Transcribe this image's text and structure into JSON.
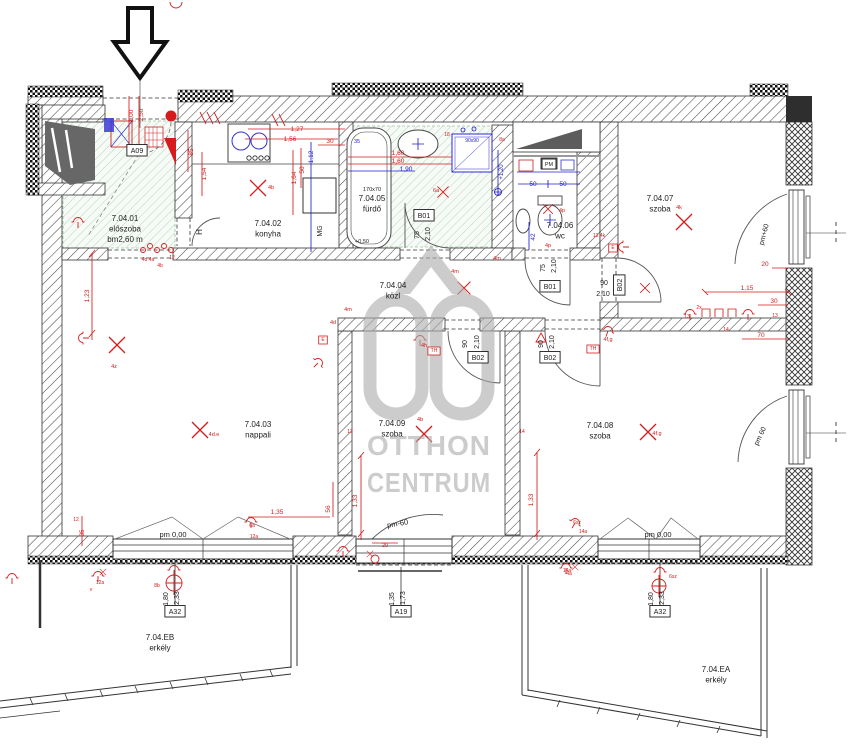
{
  "watermark": {
    "line1": "OTTHON",
    "line2": "CENTRUM",
    "logo": "oc-house-logo",
    "color": "#ababab"
  },
  "rooms": [
    {
      "id": "7.04.01",
      "name": "előszoba",
      "extra": "bm2,60 m",
      "x": 125,
      "y": 221
    },
    {
      "id": "7.04.02",
      "name": "konyha",
      "x": 268,
      "y": 226
    },
    {
      "id": "7.04.05",
      "name": "fürdő",
      "size_note": "170x70",
      "x": 372,
      "y": 201
    },
    {
      "id": "7.04.04",
      "name": "közl",
      "x": 393,
      "y": 288
    },
    {
      "id": "7.04.06",
      "name": "wc",
      "x": 560,
      "y": 228
    },
    {
      "id": "7.04.07",
      "name": "szoba",
      "x": 660,
      "y": 201
    },
    {
      "id": "7.04.03",
      "name": "nappali",
      "x": 258,
      "y": 427
    },
    {
      "id": "7.04.09",
      "name": "szoba",
      "x": 392,
      "y": 426
    },
    {
      "id": "7.04.08",
      "name": "szoba",
      "x": 600,
      "y": 428
    },
    {
      "id": "7.04.EB",
      "name": "erkély",
      "x": 160,
      "y": 640
    },
    {
      "id": "7.04.EA",
      "name": "erkély",
      "x": 716,
      "y": 672
    }
  ],
  "door_tags": [
    {
      "t": "A09",
      "x": 137,
      "y": 153
    },
    {
      "t": "B01",
      "x": 424,
      "y": 218
    },
    {
      "t": "B01",
      "x": 550,
      "y": 289
    },
    {
      "t": "B02",
      "x": 478,
      "y": 360
    },
    {
      "t": "B02",
      "x": 550,
      "y": 360
    },
    {
      "t": "B02",
      "x": 622,
      "y": 285,
      "r": -90
    },
    {
      "t": "A32",
      "x": 175,
      "y": 614
    },
    {
      "t": "A19",
      "x": 401,
      "y": 614
    },
    {
      "t": "A32",
      "x": 660,
      "y": 614
    },
    {
      "t": "PM",
      "x": 549,
      "y": 166,
      "s": 5.5
    }
  ],
  "dims_black": [
    {
      "t": "75",
      "x": 419,
      "y": 235,
      "r": -90
    },
    {
      "t": "2,10",
      "x": 430,
      "y": 234,
      "r": -90
    },
    {
      "t": "75",
      "x": 545,
      "y": 268,
      "r": -90
    },
    {
      "t": "2,10",
      "x": 556,
      "y": 266,
      "r": -90
    },
    {
      "t": "90",
      "x": 467,
      "y": 344,
      "r": -90
    },
    {
      "t": "2,10",
      "x": 479,
      "y": 342,
      "r": -90
    },
    {
      "t": "90",
      "x": 543,
      "y": 344,
      "r": -90
    },
    {
      "t": "2,10",
      "x": 554,
      "y": 342,
      "r": -90
    },
    {
      "t": "90",
      "x": 604,
      "y": 285
    },
    {
      "t": "2,10",
      "x": 603,
      "y": 296
    },
    {
      "t": "1,80",
      "x": 168,
      "y": 599,
      "r": -90
    },
    {
      "t": "2,33",
      "x": 179,
      "y": 598,
      "r": -90
    },
    {
      "t": "1,35",
      "x": 394,
      "y": 599,
      "r": -90
    },
    {
      "t": "1,73",
      "x": 405,
      "y": 598,
      "r": -90
    },
    {
      "t": "1,80",
      "x": 653,
      "y": 599,
      "r": -90
    },
    {
      "t": "2,33",
      "x": 664,
      "y": 598,
      "r": -90
    },
    {
      "t": "pm 0,00",
      "x": 173,
      "y": 537,
      "s": 7.5
    },
    {
      "t": "pm-60",
      "x": 398,
      "y": 526,
      "r": -10,
      "s": 7.5
    },
    {
      "t": "pm 0,00",
      "x": 658,
      "y": 537,
      "s": 7.5
    },
    {
      "t": "pm+60",
      "x": 766,
      "y": 235,
      "r": -75
    },
    {
      "t": "pm 60",
      "x": 762,
      "y": 437,
      "r": -65
    },
    {
      "t": "+0,50",
      "x": 362,
      "y": 243,
      "s": 5.5
    },
    {
      "t": "H",
      "x": 202,
      "y": 232,
      "r": -90,
      "s": 8
    },
    {
      "t": "MG",
      "x": 322,
      "y": 231,
      "r": -90
    }
  ],
  "dims_red": [
    {
      "t": "1,00",
      "x": 133,
      "y": 116,
      "r": -90
    },
    {
      "t": "2,50",
      "x": 143,
      "y": 115,
      "r": -90
    },
    {
      "t": "85",
      "x": 193,
      "y": 152,
      "r": -90
    },
    {
      "t": "1,54",
      "x": 206,
      "y": 174,
      "r": -90
    },
    {
      "t": "1,27",
      "x": 297,
      "y": 131
    },
    {
      "t": "1,56",
      "x": 290,
      "y": 141
    },
    {
      "t": "30",
      "x": 330,
      "y": 143
    },
    {
      "t": "50",
      "x": 304,
      "y": 170,
      "r": -90
    },
    {
      "t": "1,64",
      "x": 296,
      "y": 178,
      "r": -90
    },
    {
      "t": "1,60",
      "x": 398,
      "y": 155
    },
    {
      "t": "1,60",
      "x": 398,
      "y": 163
    },
    {
      "t": "1,23",
      "x": 89,
      "y": 296,
      "r": -90
    },
    {
      "t": "1,15",
      "x": 747,
      "y": 290
    },
    {
      "t": "30",
      "x": 774,
      "y": 303
    },
    {
      "t": "20",
      "x": 765,
      "y": 266
    },
    {
      "t": "70",
      "x": 761,
      "y": 337
    },
    {
      "t": "1,35",
      "x": 277,
      "y": 514
    },
    {
      "t": "56",
      "x": 330,
      "y": 509,
      "r": -90
    },
    {
      "t": "1,33",
      "x": 357,
      "y": 501,
      "r": -90
    },
    {
      "t": "1,33",
      "x": 533,
      "y": 500,
      "r": -90
    },
    {
      "t": "20",
      "x": 385,
      "y": 547,
      "s": 5.5
    },
    {
      "t": "35",
      "x": 84,
      "y": 533,
      "r": -90,
      "s": 6
    },
    {
      "t": "12",
      "x": 76,
      "y": 521,
      "s": 5
    },
    {
      "t": "12a",
      "x": 100,
      "y": 584,
      "s": 5
    },
    {
      "t": "v",
      "x": 91,
      "y": 591,
      "s": 5
    }
  ],
  "dims_blue": [
    {
      "t": "1,12",
      "x": 313,
      "y": 157,
      "r": -90
    },
    {
      "t": "1,90",
      "x": 406,
      "y": 171
    },
    {
      "t": "35",
      "x": 357,
      "y": 143,
      "s": 5.5
    },
    {
      "t": "50",
      "x": 533,
      "y": 186
    },
    {
      "t": "50",
      "x": 563,
      "y": 186
    },
    {
      "t": "42",
      "x": 535,
      "y": 237,
      "r": -90
    },
    {
      "t": "+1,20",
      "x": 503,
      "y": 172,
      "r": -90,
      "s": 6
    },
    {
      "t": "90x90",
      "x": 472,
      "y": 142,
      "s": 5
    }
  ],
  "markers_red": [
    {
      "t": "4b",
      "x": 271,
      "y": 189
    },
    {
      "t": "4k",
      "x": 679,
      "y": 209
    },
    {
      "t": "4d.e",
      "x": 214,
      "y": 436
    },
    {
      "t": "4b",
      "x": 420,
      "y": 421
    },
    {
      "t": "4f.g",
      "x": 657,
      "y": 435
    },
    {
      "t": "6a",
      "x": 436,
      "y": 192
    },
    {
      "t": "4z",
      "x": 114,
      "y": 368
    },
    {
      "t": "4m",
      "x": 455,
      "y": 273
    },
    {
      "t": "4m",
      "x": 497,
      "y": 260
    },
    {
      "t": "4m",
      "x": 348,
      "y": 311
    },
    {
      "t": "4p",
      "x": 562,
      "y": 212
    },
    {
      "t": "4p",
      "x": 548,
      "y": 247
    },
    {
      "t": "13 4k",
      "x": 599,
      "y": 237,
      "s": 5
    },
    {
      "t": "8a",
      "x": 502,
      "y": 141,
      "s": 5
    },
    {
      "t": "18",
      "x": 447,
      "y": 136,
      "s": 5
    },
    {
      "t": "6sz",
      "x": 673,
      "y": 578,
      "s": 5
    },
    {
      "t": "8b",
      "x": 157,
      "y": 587,
      "s": 5
    },
    {
      "t": "4a",
      "x": 569,
      "y": 575,
      "s": 5
    },
    {
      "t": "6sz",
      "x": 577,
      "y": 524,
      "s": 5
    },
    {
      "t": "14a",
      "x": 583,
      "y": 533,
      "s": 5
    },
    {
      "t": "2x",
      "x": 699,
      "y": 309,
      "s": 5
    },
    {
      "t": "13",
      "x": 687,
      "y": 318,
      "s": 5
    },
    {
      "t": "13",
      "x": 775,
      "y": 317,
      "s": 5
    },
    {
      "t": "14",
      "x": 726,
      "y": 331,
      "s": 5
    },
    {
      "t": "4h",
      "x": 424,
      "y": 347
    },
    {
      "t": "4d",
      "x": 333,
      "y": 324
    },
    {
      "t": "4f,g",
      "x": 608,
      "y": 341
    },
    {
      "t": "4d 4a",
      "x": 148,
      "y": 261,
      "s": 5
    },
    {
      "t": "4b",
      "x": 160,
      "y": 267,
      "s": 5
    },
    {
      "t": "12",
      "x": 172,
      "y": 259,
      "s": 5
    },
    {
      "t": "6a",
      "x": 252,
      "y": 527,
      "s": 5
    },
    {
      "t": "12a",
      "x": 254,
      "y": 538,
      "s": 5
    },
    {
      "t": "14a",
      "x": 567,
      "y": 572,
      "s": 5
    },
    {
      "t": "13",
      "x": 350,
      "y": 433,
      "s": 5
    },
    {
      "t": "14",
      "x": 522,
      "y": 433,
      "s": 5
    }
  ],
  "red_boxes": [
    {
      "t": "TH",
      "x": 434,
      "y": 352
    },
    {
      "t": "TH",
      "x": 593,
      "y": 350
    },
    {
      "t": "E",
      "x": 323,
      "y": 341
    },
    {
      "t": "E",
      "x": 613,
      "y": 249
    }
  ]
}
